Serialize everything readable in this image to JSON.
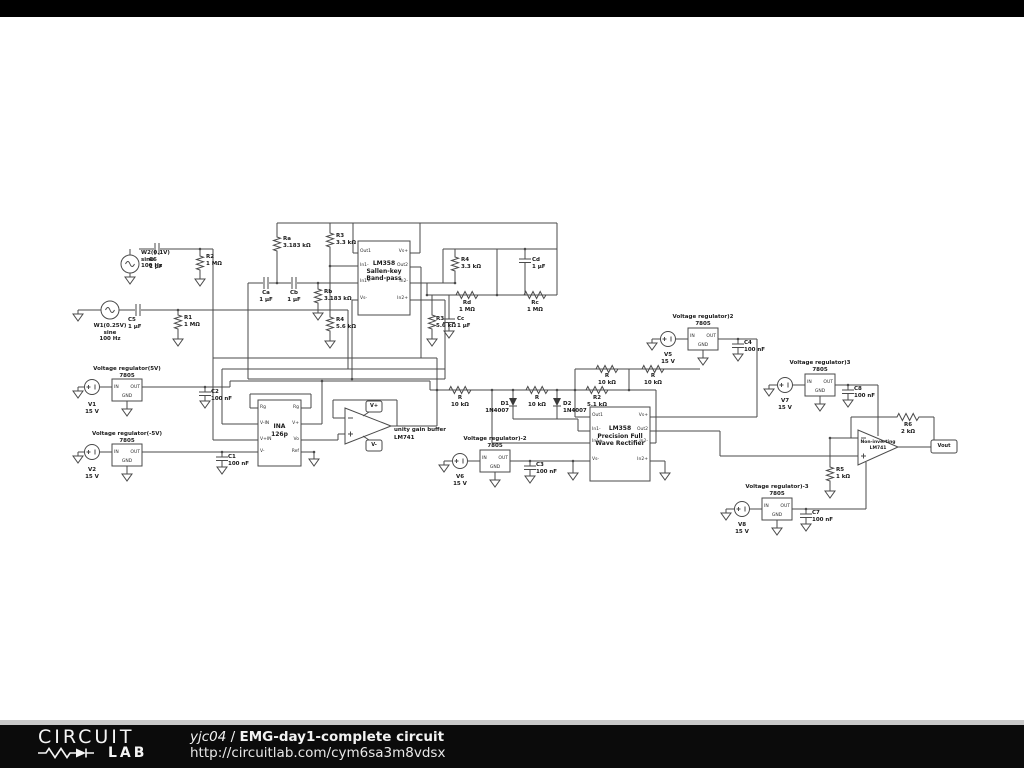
{
  "footer": {
    "logo_line1": "CIRCUIT",
    "logo_line2": "LAB",
    "author": "yjc04",
    "separator": " / ",
    "title": "EMG-day1-complete circuit",
    "url": "http://circuitlab.com/cym6sa3m8vdsx"
  },
  "colors": {
    "wire": "#4a4a4a",
    "text": "#1a1a1a",
    "footer_bg": "#0b0b0b"
  },
  "reg_pins": {
    "in": "IN",
    "out": "OUT",
    "gnd": "GND"
  },
  "ics": {
    "bandpass": {
      "title": "LM358\nSallen-key\nBand-pass",
      "pins_left": [
        "Out1",
        "In1-",
        "In1+",
        "Vs-"
      ],
      "pins_right": [
        "Vs+",
        "Out2",
        "In2-",
        "In2+"
      ]
    },
    "rectifier": {
      "title": "LM358\nPrecision Full\nWave Rectifier",
      "pins_left": [
        "Out1",
        "In1-",
        "In1+",
        "Vs-"
      ],
      "pins_right": [
        "Vs+",
        "Out2",
        "In2-",
        "In2+"
      ]
    },
    "ina": {
      "title": "INA\n126p",
      "pins_left": [
        "Rg",
        "V-IN",
        "V+IN",
        "V-"
      ],
      "pins_right": [
        "Rg",
        "V+",
        "Vo",
        "Ref"
      ]
    },
    "buffer": {
      "title": "unity gain buffer\nLM741"
    },
    "noninverting": {
      "title": "Non-inverting\nLM741"
    }
  },
  "flags": {
    "vplus": "V+",
    "vminus": "V-",
    "vout": "Vout"
  },
  "parts": {
    "w2": "W2(0.1V)\nsine\n100 Hz",
    "c6": "C6\n1 µF",
    "r2": "R2\n1 MΩ",
    "w1": "W1(0.25V)\nsine\n100 Hz",
    "c5": "C5\n1 µF",
    "r1": "R1\n1 MΩ",
    "ra": "Ra\n3.183 kΩ",
    "r3_1": "R3\n3.3 kΩ",
    "ca": "Ca\n1 µF",
    "cb": "Cb\n1 µF",
    "rb": "Rb\n3.183 kΩ",
    "r4_1": "R4\n5.6 kΩ",
    "r4_2": "R4\n3.3 kΩ",
    "cd": "Cd\n1 µF",
    "rd": "Rd\n1 MΩ",
    "rc": "Rc\n1 MΩ",
    "r3_2": "R3\n5.6 kΩ",
    "cc": "Cc\n1 µF",
    "vr1": "Voltage regulator(5V)\n7805",
    "v1": "V1\n15 V",
    "c2": "C2\n100 nF",
    "vr2": "Voltage regulator(-5V)\n7805",
    "v2": "V2\n15 V",
    "c1": "C1\n100 nF",
    "r_in": "R\n10 kΩ",
    "r_mid": "R\n10 kΩ",
    "r2_5k1": "R2\n5.1 kΩ",
    "r_fb1": "R\n10 kΩ",
    "r_fb2": "R\n10 kΩ",
    "d1": "D1\n1N4007",
    "d2": "D2\n1N4007",
    "vr3": "Voltage regulator)2\n7805",
    "v5": "V5\n15 V",
    "c4": "C4\n100 nF",
    "vr4": "Voltage regulator)-2\n7805",
    "v6": "V6\n15 V",
    "c3": "C3\n100 nF",
    "vr5": "Voltage regulator)3\n7805",
    "v7": "V7\n15 V",
    "c8": "C8\n100 nF",
    "vr6": "Voltage regulator)-3\n7805",
    "v8": "V8\n15 V",
    "c7": "C7\n100 nF",
    "r5": "R5\n1 kΩ",
    "r6": "R6\n2 kΩ"
  }
}
